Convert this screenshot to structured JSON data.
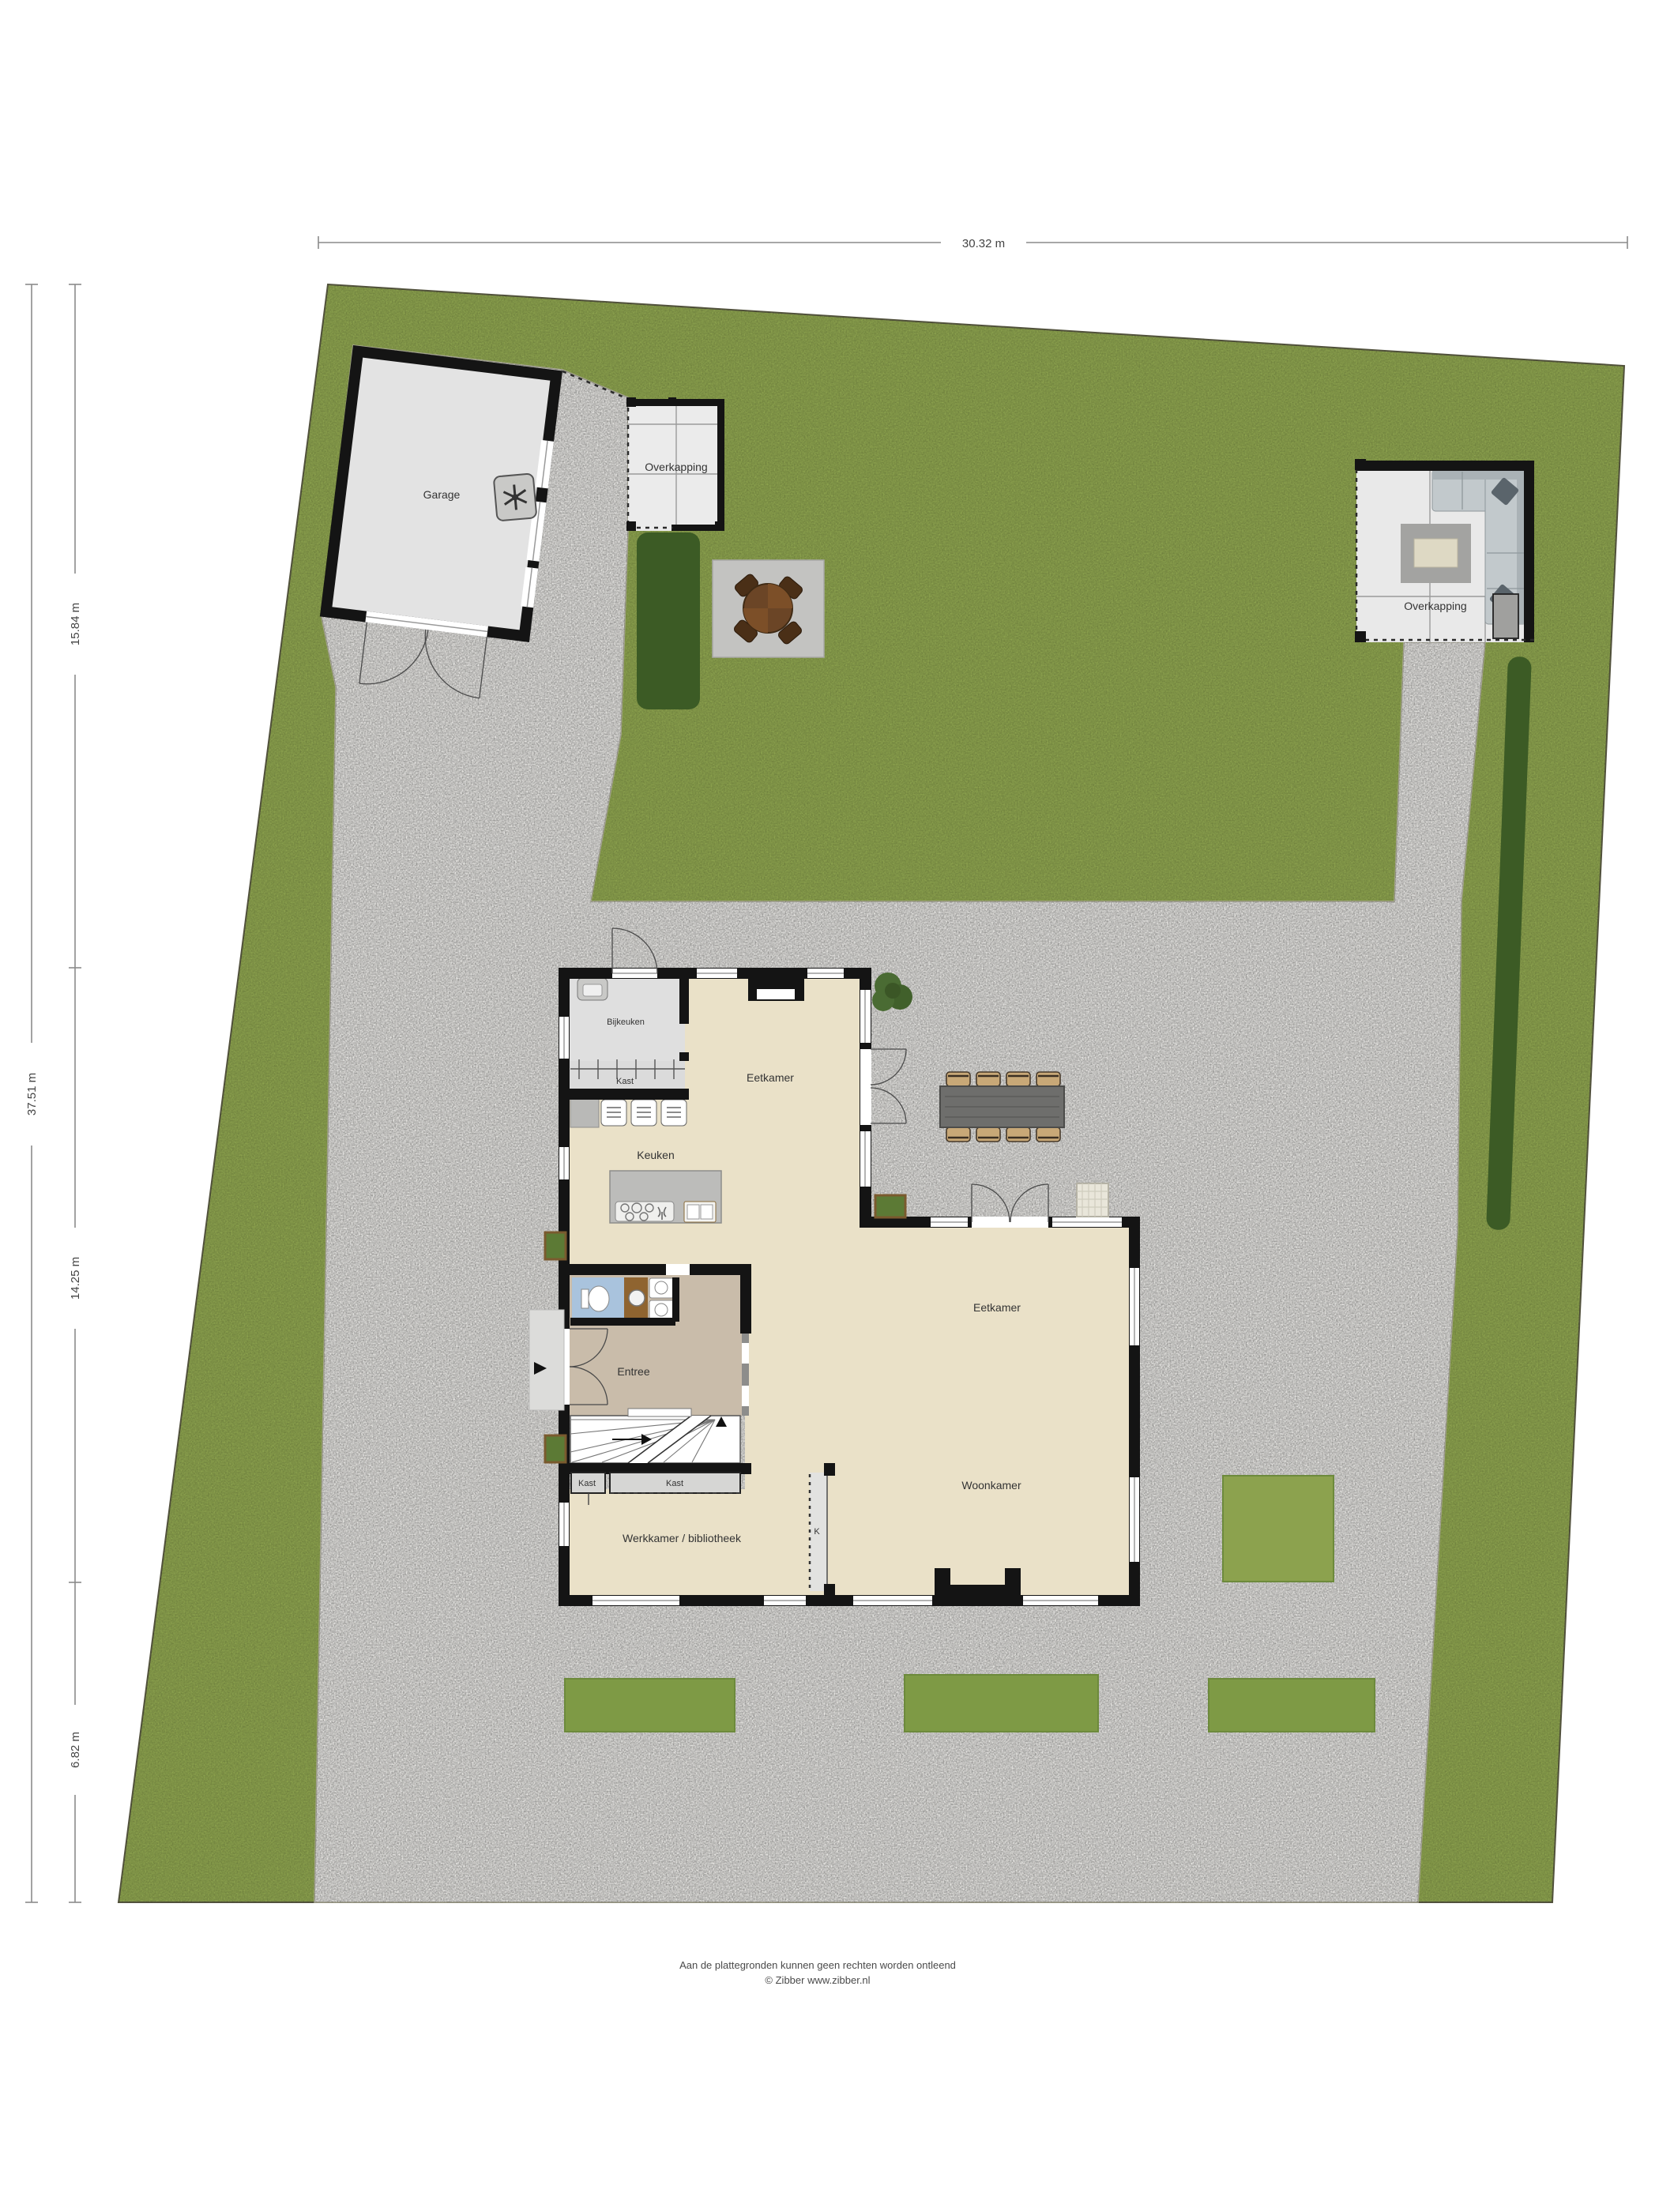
{
  "plan_title": "Situatie / begane grond plattegrond",
  "dimensions": {
    "top": "30.32 m",
    "left_total": "37.51 m",
    "left_upper": "15.84 m",
    "left_middle": "14.25 m",
    "left_lower": "6.82 m"
  },
  "outbuildings": {
    "garage": "Garage",
    "overkapping_top": "Overkapping",
    "overkapping_right": "Overkapping"
  },
  "rooms": {
    "bijkeuken": "Bijkeuken",
    "kast_top": "Kast",
    "eetkamer_top": "Eetkamer",
    "keuken": "Keuken",
    "entree": "Entree",
    "eetkamer": "Eetkamer",
    "woonkamer": "Woonkamer",
    "kast_small": "Kast",
    "kast_wide": "Kast",
    "werkkamer": "Werkkamer / bibliotheek",
    "k": "K"
  },
  "footer": {
    "line1": "Aan de plattegronden kunnen geen rechten worden ontleend",
    "line2": "© Zibber www.zibber.nl"
  },
  "colors": {
    "grass": "#8ca24e",
    "hedge": "#3c5b25",
    "gravel": "#e7e6e3",
    "wall": "#141414",
    "house-floor": "#eae1c8",
    "entree-floor": "#c9bcaa",
    "wc-floor": "#a9c3dd"
  }
}
